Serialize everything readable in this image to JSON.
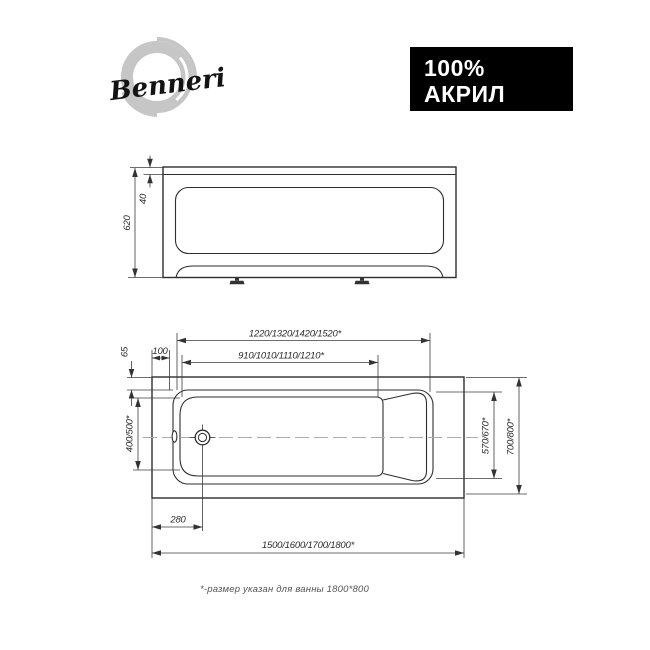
{
  "brand": {
    "name": "Benneri"
  },
  "badge": {
    "line1": "100%",
    "line2": "АКРИЛ",
    "bg": "#000000",
    "text_color": "#ffffff"
  },
  "front_view": {
    "total_height": "620",
    "rim_height": "40"
  },
  "top_view": {
    "rim_length": "1220/1320/1420/1520*",
    "bottom_length": "910/1010/1110/1210*",
    "edge_offset": "100",
    "rim_side_width": "65",
    "head_end_width": "400/500*",
    "inner_width": "570/670*",
    "overall_width": "700/800*",
    "drain_offset": "280",
    "overall_length": "1500/1600/1700/1800*"
  },
  "footnote": {
    "text": "*-размер указан для ванны 1800*800"
  },
  "colors": {
    "line": "#2e2e2e",
    "centerline": "#ababab",
    "badge_bg": "#000000",
    "badge_text": "#ffffff",
    "logo_swirl": "#c6c6c6"
  }
}
